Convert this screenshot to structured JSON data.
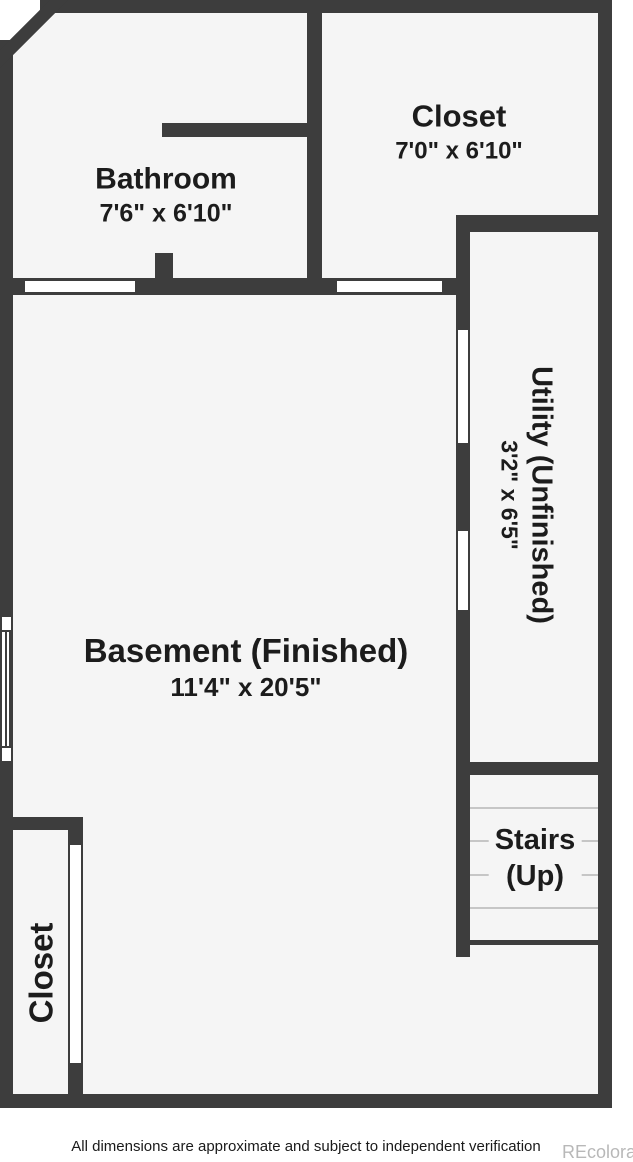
{
  "colors": {
    "wall": "#3d3d3d",
    "floor": "#f5f5f5",
    "tread": "#c6c6c6",
    "text": "#1c1c1c",
    "watermark": "#b8b8b8"
  },
  "rooms": {
    "bathroom": {
      "label": "Bathroom",
      "dimensions": "7'6\" x 6'10\""
    },
    "closet_top_right": {
      "label": "Closet",
      "dimensions": "7'0\" x 6'10\""
    },
    "utility": {
      "label": "Utility (Unfinished)",
      "dimensions": "3'2\" x 6'5\""
    },
    "basement": {
      "label": "Basement (Finished)",
      "dimensions": "11'4\" x 20'5\""
    },
    "stairs": {
      "label_line1": "Stairs",
      "label_line2": "(Up)"
    },
    "closet_bottom_left": {
      "label": "Closet"
    }
  },
  "footer": {
    "disclaimer": "All dimensions are approximate and subject to independent verification",
    "watermark": "REcolorado"
  }
}
